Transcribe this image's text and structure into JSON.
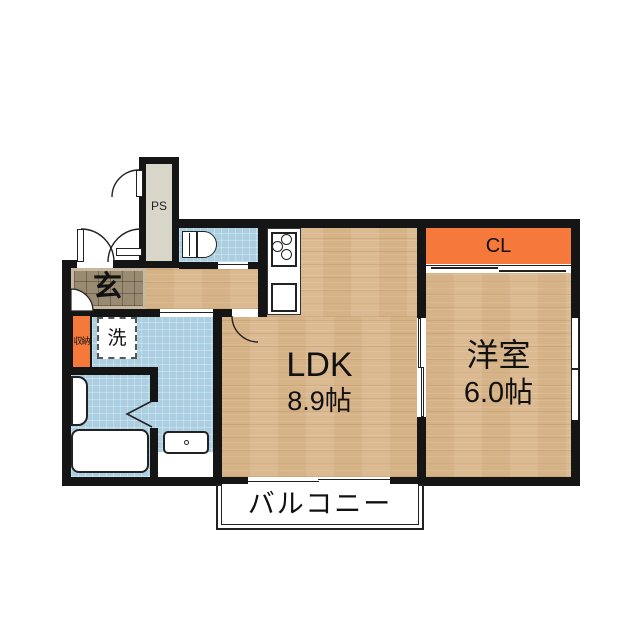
{
  "plan": {
    "rooms": {
      "ldk": {
        "label": "LDK",
        "size": "8.9帖"
      },
      "western_room": {
        "label": "洋室",
        "size": "6.0帖"
      },
      "closet": {
        "label": "CL"
      },
      "pipe_space": {
        "label": "PS"
      },
      "entrance": {
        "label": "玄"
      },
      "storage": {
        "label": "収納"
      },
      "washer": {
        "label": "洗"
      },
      "balcony": {
        "label": "バルコニー"
      }
    },
    "colors": {
      "wall": "#151515",
      "wood_floor": "#d9b68c",
      "water_area_blue": "#abcfe0",
      "accent_orange": "#f5793a",
      "entrance_tile": "#998a72",
      "ps_gray": "#d8d5c9"
    }
  }
}
